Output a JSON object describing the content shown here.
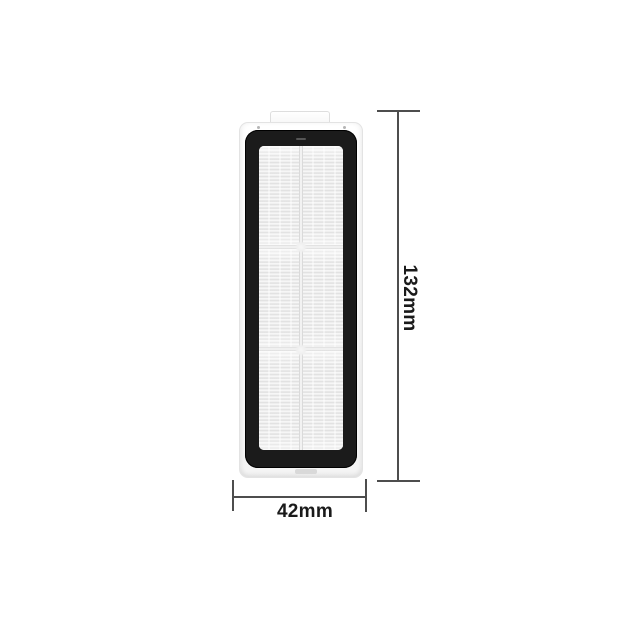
{
  "page": {
    "background_color": "#ffffff"
  },
  "product": {
    "seal_frame_color": "#1b1b1b",
    "body_color": "#fbfbfb",
    "filter_media_color": "#ececec"
  },
  "dimensions": {
    "line_color": "#4d4d4d",
    "text_color": "#1a1a1a",
    "height": {
      "label": "132mm"
    },
    "width": {
      "label": "42mm"
    }
  }
}
